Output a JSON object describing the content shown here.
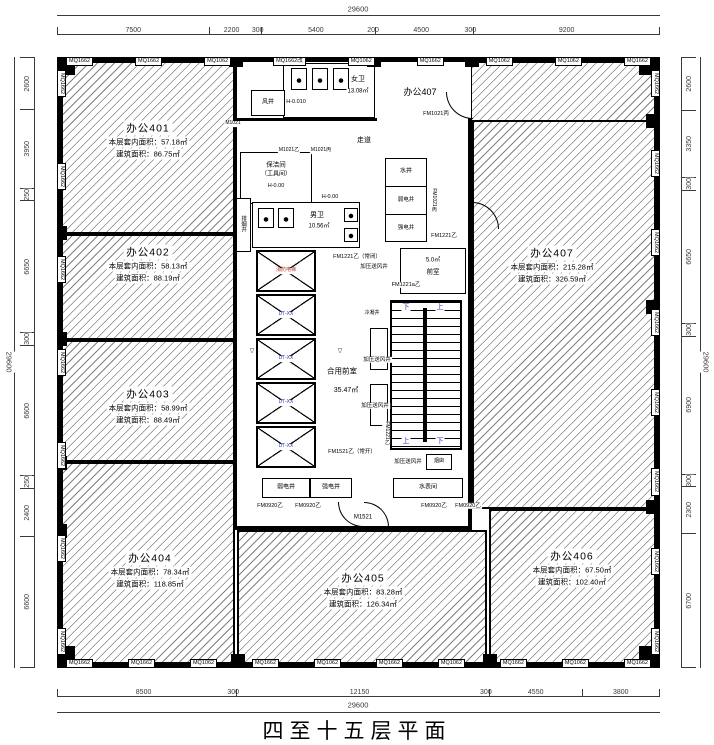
{
  "title": "四至十五层平面",
  "dims": {
    "total": "29600",
    "top": [
      "7500",
      "2200",
      "300",
      "5400",
      "200",
      "4500",
      "300",
      "9200"
    ],
    "bottom": [
      "8500",
      "300",
      "12150",
      "300",
      "4550",
      "3800"
    ],
    "left": [
      "2600",
      "3950",
      "250",
      "6650",
      "300",
      "6600",
      "250",
      "2400",
      "6600"
    ],
    "right": [
      "2600",
      "3350",
      "300",
      "6650",
      "300",
      "6900",
      "300",
      "2300",
      "6700"
    ]
  },
  "windows": {
    "top": [
      "MQ1662",
      "MQ1662",
      "MQ1062",
      "MQ1662改",
      "MQ1062",
      "MQ1662",
      "MQ1062",
      "MQ1062",
      "MQ1662"
    ],
    "bottom": [
      "MQ1662",
      "MQ1662",
      "MQ1062",
      "MQ1662",
      "MQ1062",
      "MQ1662",
      "MQ1062",
      "MQ1662",
      "MQ1062",
      "MQ1662"
    ],
    "left": [
      "MQ1662",
      "MQ1662",
      "MQ1662",
      "MQ1662",
      "MQ1662",
      "MQ1662",
      "MQ1662"
    ],
    "right": [
      "MQ1662",
      "MQ1662",
      "MQ1662",
      "MQ1662",
      "MQ1662",
      "MQ1662",
      "MQ1662",
      "MQ1662"
    ]
  },
  "rooms": {
    "r401": {
      "name": "办公401",
      "inner": "本层套内面积：57.18㎡",
      "gross": "建筑面积：86.75㎡"
    },
    "r402": {
      "name": "办公402",
      "inner": "本层套内面积：58.13㎡",
      "gross": "建筑面积：88.19㎡"
    },
    "r403": {
      "name": "办公403",
      "inner": "本层套内面积：58.99㎡",
      "gross": "建筑面积：88.49㎡"
    },
    "r404": {
      "name": "办公404",
      "inner": "本层套内面积：78.34㎡",
      "gross": "建筑面积：118.85㎡"
    },
    "r405": {
      "name": "办公405",
      "inner": "本层套内面积：83.28㎡",
      "gross": "建筑面积：126.34㎡"
    },
    "r406": {
      "name": "办公406",
      "inner": "本层套内面积：67.50㎡",
      "gross": "建筑面积：102.40㎡"
    },
    "r407": {
      "name": "办公407",
      "inner": "本层套内面积：215.28㎡",
      "gross": "建筑面积：326.59㎡"
    },
    "r407_tag": "办公407"
  },
  "core": {
    "female_wc": "女卫",
    "female_wc_area": "13.08㎡",
    "level_a": "H-0.010",
    "level_b": "H-0.00",
    "male_wc": "男卫",
    "male_wc_area": "10.56㎡",
    "cleaning_room": "保洁间",
    "cleaning_room_sub": "（工具间）",
    "corridor": "走道",
    "air_shaft": "风井",
    "water_shaft": "水井",
    "weak_power_shaft": "弱电井",
    "strong_power_shaft": "强电井",
    "smoke_shaft": "排烟井",
    "condensate_shaft": "冷凝井",
    "pressurized_shaft": "加压送风井",
    "front_room": "前室",
    "front_room_area": "5.0㎡",
    "shared_lobby": "合用前室",
    "shared_lobby_area": "35.47㎡",
    "water_meter_room": "水表间",
    "chimney": "烟囱",
    "stair_up": "上",
    "stair_down": "下",
    "fire_elevator": "消防电梯",
    "elevator": "DT-XX",
    "level_mark": "▽"
  },
  "doors": {
    "m1021": "M1021",
    "m1021b": "M1021乙",
    "m1021c": "M1021丙",
    "fm1021c": "FM1021丙",
    "fm1221": "FM1221乙",
    "fm1221nc": "FM1221乙（常闭）",
    "fm1221a": "FM1221a乙",
    "fm1521no": "FM1521乙（常开）",
    "fm0920": "FM0920乙",
    "m1521": "M1521"
  },
  "colors": {
    "line": "#000000",
    "dim": "#3a3a3a",
    "stair_label": "#2a3bb5",
    "elevator_label": "#2a3bb5",
    "fire_elevator_label": "#b03a2e"
  }
}
